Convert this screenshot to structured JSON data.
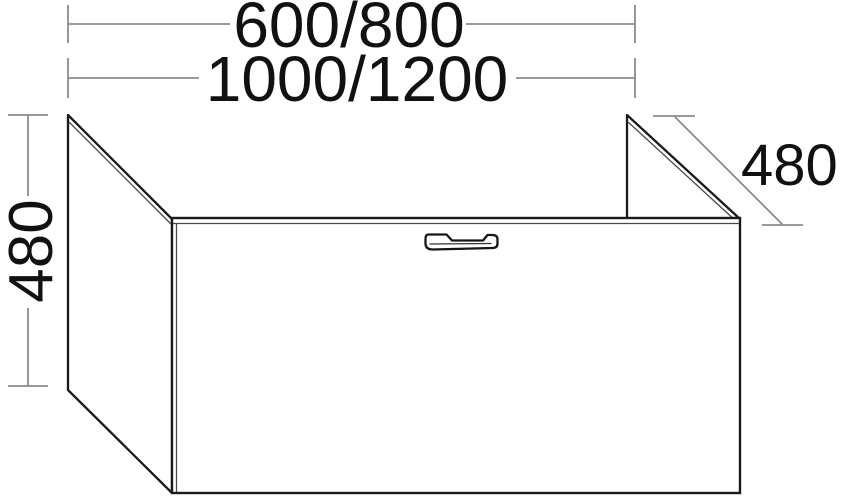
{
  "drawing": {
    "labels": {
      "width_small": "600/800",
      "width_large": "1000/1200",
      "height_left": "480",
      "depth_right": "480"
    },
    "colors": {
      "background": "#ffffff",
      "cabinet_outline": "#1a1a1a",
      "cabinet_inner_edge": "#4a4a4a",
      "dimension_line": "#8c8c8c",
      "label_text": "#111111"
    }
  }
}
